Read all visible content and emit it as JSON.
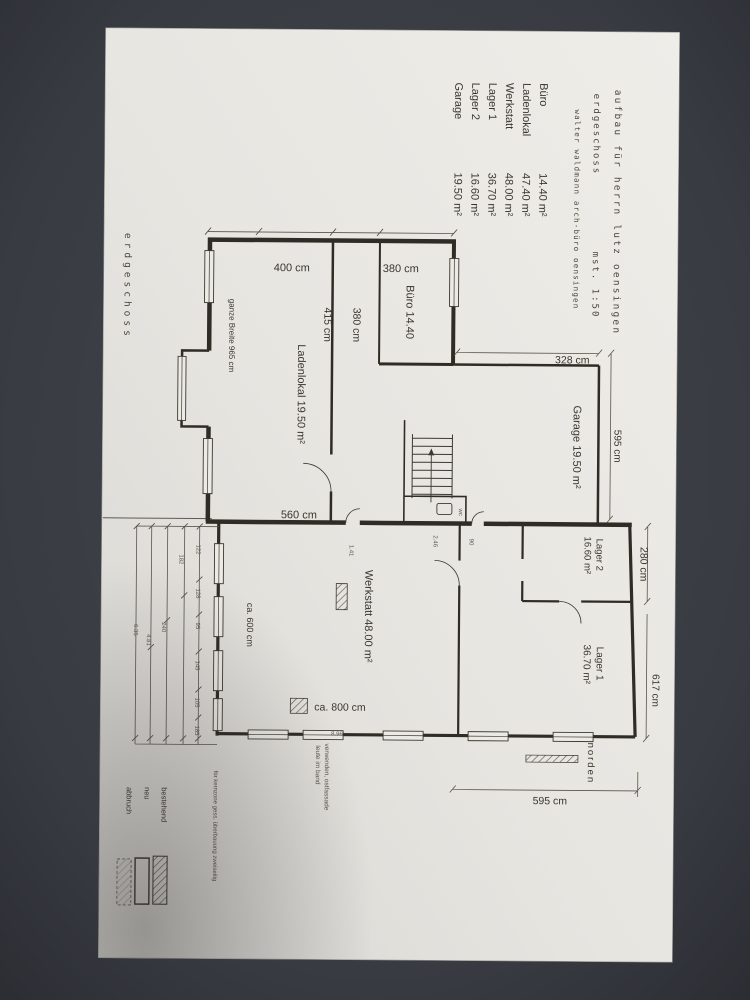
{
  "colors": {
    "background": "#383b42",
    "paper": "#e9e7e2",
    "ink": "#3a362f",
    "wall": "#2f2b25"
  },
  "header": {
    "rooms": [
      {
        "name": "Büro",
        "area": "14.40 m²"
      },
      {
        "name": "Ladenlokal",
        "area": "47.40 m²"
      },
      {
        "name": "Werkstatt",
        "area": "48.00 m²"
      },
      {
        "name": "Lager 1",
        "area": "36.70 m²"
      },
      {
        "name": "Lager 2",
        "area": "16.60 m²"
      },
      {
        "name": "Garage",
        "area": "19.50 m²"
      }
    ],
    "title_block": {
      "project": "aufbau für herrn lutz oensingen",
      "floor": "erdgeschoss",
      "scale": "mst. 1:50",
      "architect": "walter waldmann arch-büro oensingen"
    },
    "side_label": "erdgeschoss"
  },
  "plan": {
    "labels": {
      "dim_400": "400 cm",
      "dim_380_top": "380 cm",
      "buero": "Büro 14.40",
      "dim_380": "380 cm",
      "dim_415": "415 cm",
      "ladenlokal": "Ladenlokal 19.50 m²",
      "ganze_breite": "ganze Breite 965 cm",
      "dim_328": "328 cm",
      "garage": "Garage 19.50 m²",
      "dim_595_garage": "595 cm",
      "dim_560": "560 cm",
      "dim_280": "280 cm",
      "lager2_name": "Lager 2",
      "lager2_area": "16.60 m²",
      "werkstatt": "Werkstatt 48.00 m²",
      "lager1_name": "Lager 1",
      "lager1_area": "36.70 m²",
      "dim_617": "617 cm",
      "dim_ca600": "ca. 600 cm",
      "dim_ca800": "ca. 800 cm",
      "dim_595_bottom": "595 cm",
      "north": "norden",
      "wc": "wc"
    },
    "small_dims": [
      "122",
      "128",
      "95",
      "145",
      "105",
      "185",
      "182",
      "240",
      "4.81",
      "6.35",
      "8.96",
      "2.46",
      "1.41",
      "90"
    ]
  },
  "notes": {
    "line1": "leute im band",
    "line2": "verwenden, ostfassade",
    "margin": "für kernzone gess. überbauung zweiseitig"
  },
  "legend": {
    "existing": "bestehend",
    "new": "neu",
    "demolition": "abbruch"
  }
}
